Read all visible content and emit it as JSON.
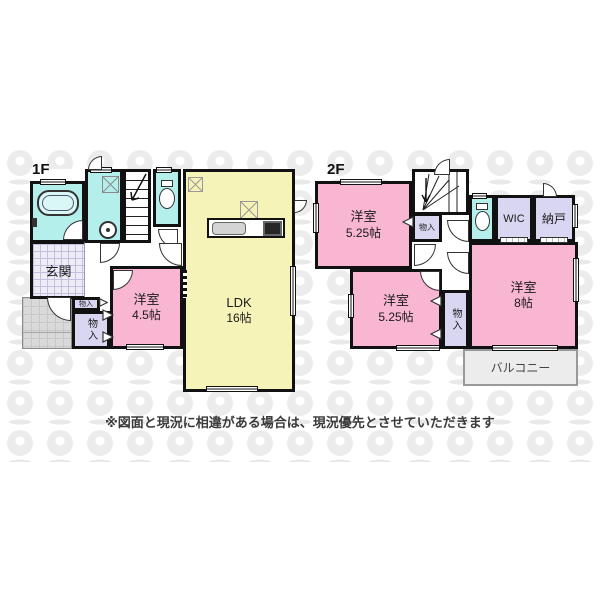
{
  "disclaimer": "※図面と現況に相違がある場合は、現況優先とさせていただきます",
  "floor1": {
    "label": "1F",
    "ldk": {
      "name": "LDK",
      "size": "16帖"
    },
    "yoshitsu": {
      "name": "洋室",
      "size": "4.5帖"
    },
    "genkan": "玄関",
    "storage_small": "物入",
    "storage_large": "物入"
  },
  "floor2": {
    "label": "2F",
    "yoshitsu_a": {
      "name": "洋室",
      "size": "5.25帖"
    },
    "yoshitsu_b": {
      "name": "洋室",
      "size": "5.25帖"
    },
    "yoshitsu_c": {
      "name": "洋室",
      "size": "8帖"
    },
    "wic": "WIC",
    "nando": "納戸",
    "storage_a": "物入",
    "storage_b": "物入",
    "balcony": "バルコニー"
  },
  "colors": {
    "room_pink": "#f8b6d3",
    "room_yellow": "#f6f3b8",
    "wet_cyan": "#b5efec",
    "storage_lavender": "#d9d6f1",
    "balcony_gray": "#ececec",
    "wall": "#111111"
  }
}
